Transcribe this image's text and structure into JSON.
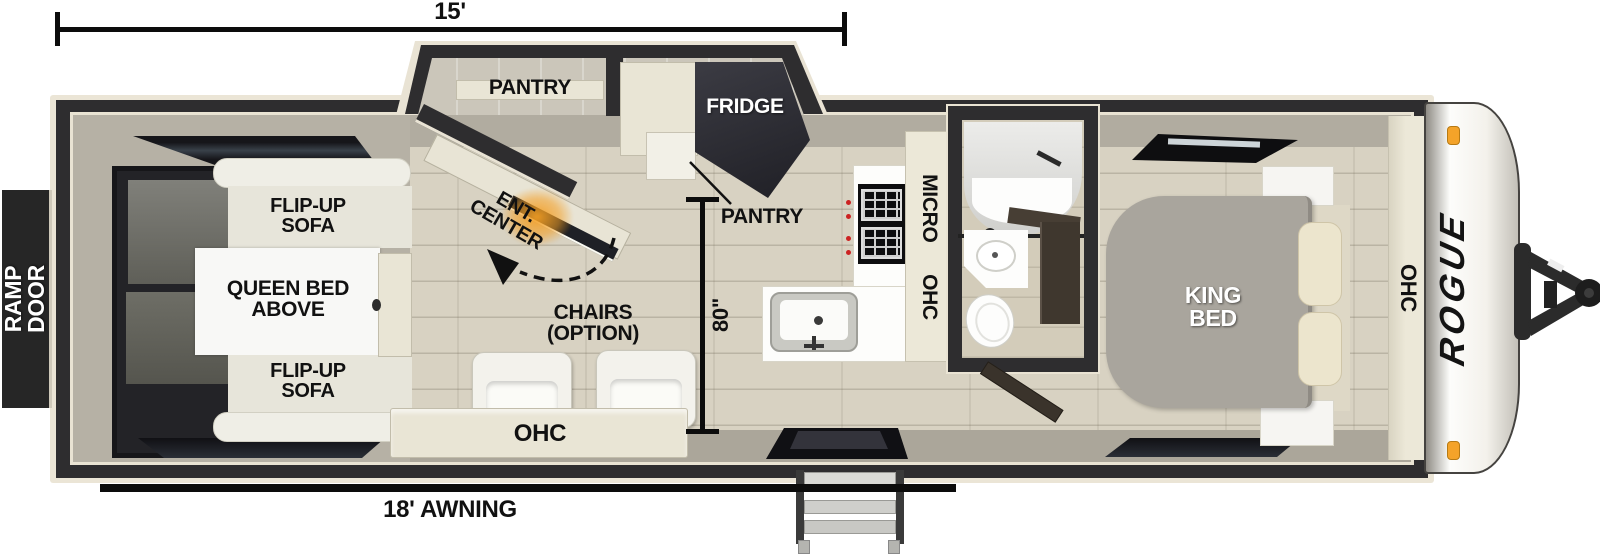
{
  "floorplan": {
    "brand": "ROGUE",
    "dims": {
      "length": "15'",
      "awning": "18' AWNING",
      "width": "80\""
    },
    "rooms": {
      "ramp_door": "RAMP DOOR",
      "sofa_front": "FLIP-UP SOFA",
      "sofa_rear": "FLIP-UP SOFA",
      "queen_bed": "QUEEN BED ABOVE",
      "ent_center": "ENT. CENTER",
      "pantry_slide": "PANTRY",
      "fridge": "FRIDGE",
      "pantry_kitchen": "PANTRY",
      "chairs": "CHAIRS (OPTION)",
      "ohc_living": "OHC",
      "micro_ohc": "MICRO OHC",
      "king_bed": "KING BED",
      "ohc_front": "OHC"
    },
    "colors": {
      "wall": "#2e2d2f",
      "trim": "#e9e3d4",
      "floor": "#d8d2c2",
      "accent_orange": "#f4a329",
      "label": "#111111"
    }
  }
}
